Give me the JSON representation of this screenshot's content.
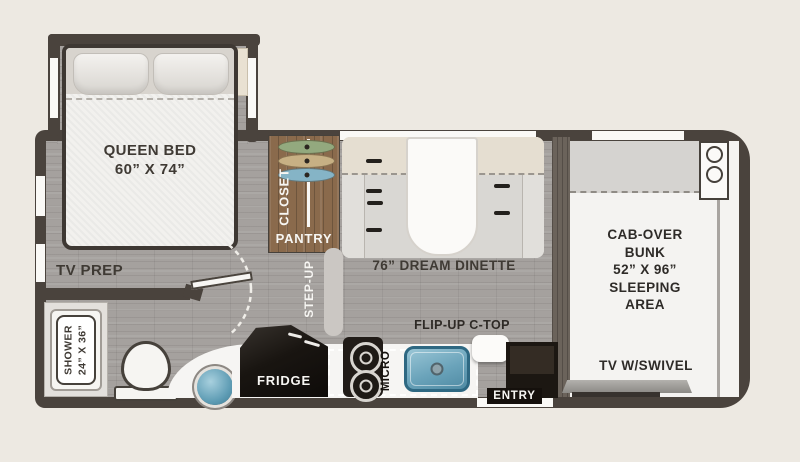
{
  "colors": {
    "background": "#EDE9E2",
    "wall": "#4A433D",
    "floor_gray": "#A5A19E",
    "closet_wood": "#8A6A4C",
    "sink_blue": "#6AA3BA",
    "hanger_green": "#93A97E",
    "hanger_tan": "#C7B084",
    "hanger_blue": "#85B4C6",
    "fridge_black": "#191511"
  },
  "floorplan": {
    "bedroom": {
      "bed_line1": "QUEEN BED",
      "bed_line2": "60” X 74”",
      "tv_prep": "TV PREP"
    },
    "bathroom": {
      "shower_line1": "SHOWER",
      "shower_line2": "24” X 36”"
    },
    "storage": {
      "closet": "CLOSET",
      "pantry": "PANTRY"
    },
    "hallway": {
      "step_up": "STEP-UP"
    },
    "dinette": {
      "label": "76” DREAM DINETTE"
    },
    "kitchen": {
      "fridge": "FRIDGE",
      "micro": "MICRO",
      "flip_up": "FLIP-UP C-TOP",
      "entry": "ENTRY"
    },
    "cab": {
      "bunk_line1": "CAB-OVER",
      "bunk_line2": "BUNK",
      "bunk_line3": "52” X 96”",
      "bunk_line4": "SLEEPING",
      "bunk_line5": "AREA",
      "tv": "TV W/SWIVEL"
    }
  }
}
